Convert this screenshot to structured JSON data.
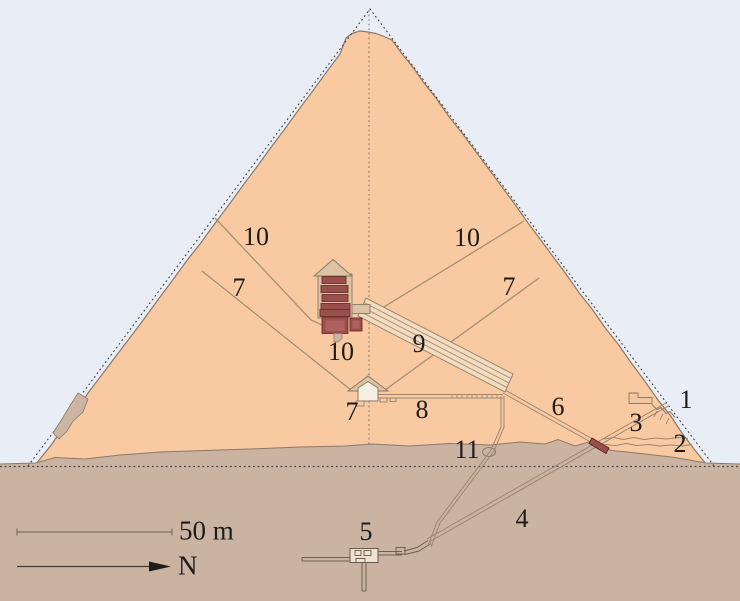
{
  "legend": {
    "scale_text": "50 m",
    "north_text": "N",
    "north_arrow_icon": "right-arrow-icon"
  },
  "labels": [
    {
      "text": "1",
      "feature": "original-entrance"
    },
    {
      "text": "2",
      "feature": "robbers-tunnel"
    },
    {
      "text": "3",
      "feature": "descending-passage-upper"
    },
    {
      "text": "4",
      "feature": "descending-passage-lower"
    },
    {
      "text": "5",
      "feature": "subterranean-chamber"
    },
    {
      "text": "6",
      "feature": "ascending-passage"
    },
    {
      "text": "7",
      "feature": "queens-chamber-north-shaft"
    },
    {
      "text": "7",
      "feature": "queens-chamber-south-shaft"
    },
    {
      "text": "7",
      "feature": "queens-chamber"
    },
    {
      "text": "8",
      "feature": "horizontal-passage"
    },
    {
      "text": "9",
      "feature": "grand-gallery"
    },
    {
      "text": "10",
      "feature": "kings-chamber-north-shaft"
    },
    {
      "text": "10",
      "feature": "kings-chamber-south-shaft"
    },
    {
      "text": "10",
      "feature": "kings-chamber"
    },
    {
      "text": "11",
      "feature": "well-shaft-grotto"
    }
  ],
  "colors": {
    "sky": "#e9edf6",
    "masonry": "#f9c9a1",
    "ground": "#cbb3a2",
    "granite": "#9a4f4c",
    "granite_light": "#ad605d",
    "limestone_roof": "#dcc3a2",
    "outline": "#8a7a6a",
    "label_text": "#1c1c1c"
  }
}
